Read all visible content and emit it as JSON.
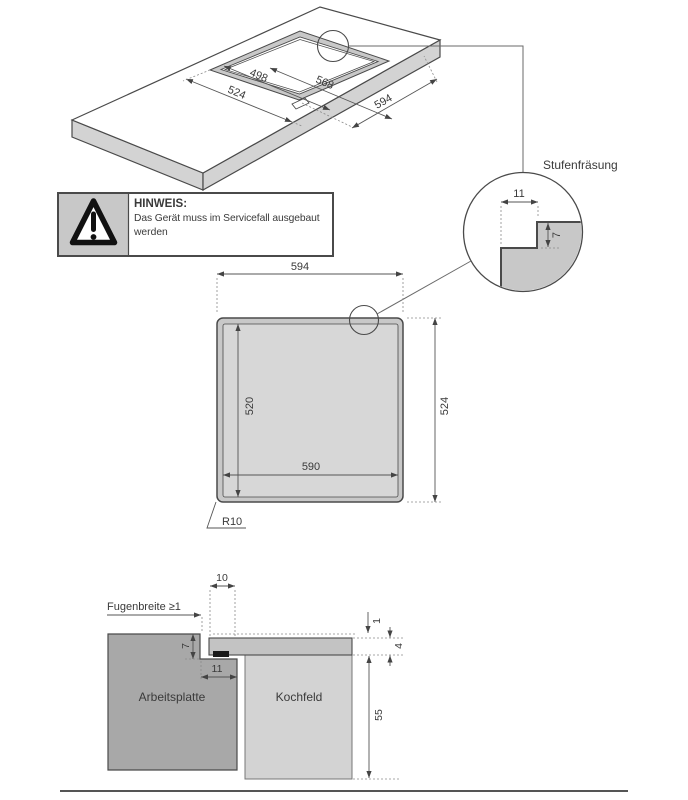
{
  "colors": {
    "line": "#4a4a4a",
    "dim_line": "#555555",
    "text": "#3a3a3a",
    "band_gray": "#c8c8c8",
    "inner_gray": "#d7d7d7",
    "side_gray": "#d3d3d3",
    "worktop_gray": "#a8a8a8",
    "glass_gray": "#c3c3c3",
    "body_gray": "#d3d3d3",
    "seal_black": "#1a1a1a"
  },
  "iso_view": {
    "dim_inner": "498",
    "dim_step": "568",
    "dim_outer": "524",
    "dim_glass": "594"
  },
  "stufenfraesung": {
    "label": "Stufenfräsung",
    "dim_width": "11",
    "dim_depth": "7"
  },
  "notice": {
    "title": "HINWEIS:",
    "line1": "Das Gerät muss im Servicefall ausgebaut",
    "line2": "werden"
  },
  "top_view": {
    "dim_width_outer": "594",
    "dim_height_outer": "524",
    "dim_height_inner": "520",
    "dim_width_inner": "590",
    "corner_radius": "R10"
  },
  "section_view": {
    "joint_label": "Fugenbreite ≥1",
    "dim_overlap": "10",
    "dim_step_depth": "7",
    "dim_step_width": "11",
    "dim_glass_offset": "1",
    "dim_glass_thickness": "4",
    "dim_body_height": "55",
    "worktop_label": "Arbeitsplatte",
    "cooktop_label": "Kochfeld"
  }
}
